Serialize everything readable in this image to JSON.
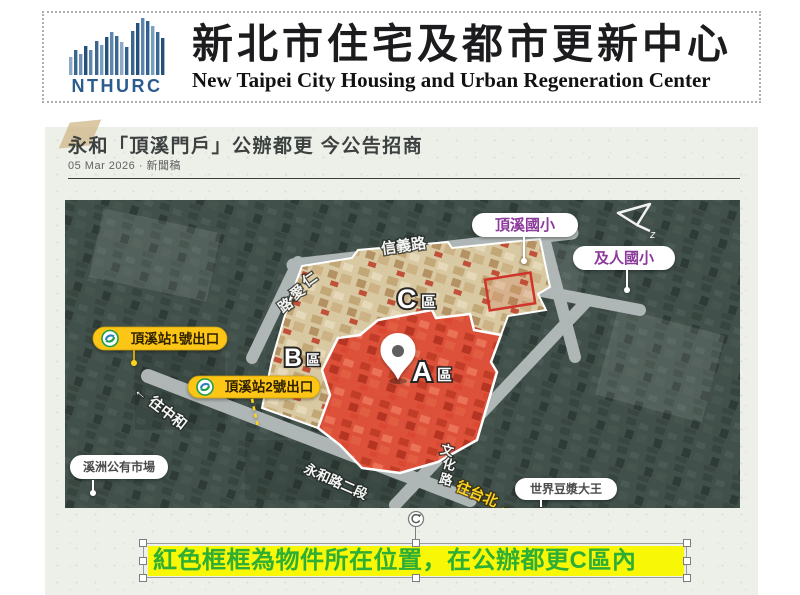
{
  "header": {
    "logo_text": "NTHURC",
    "title_zh": "新北市住宅及都市更新中心",
    "title_en": "New Taipei City Housing and Urban Regeneration Center"
  },
  "article": {
    "title": "永和「頂溪門戶」公辦都更 今公告招商",
    "date_line": "05 Mar 2026 · 新聞稿"
  },
  "map": {
    "road_labels": {
      "xinyi": "信義路",
      "renai_chars": [
        "仁",
        "愛",
        "路"
      ],
      "yonghe_section2": "永和路二段",
      "wenhua_chars": [
        "文",
        "化",
        "路"
      ]
    },
    "direction_labels": {
      "to_zhonghe": "← 往中和",
      "to_taipei": "往台北 →"
    },
    "zones": {
      "a": {
        "letter": "A",
        "suffix": "區"
      },
      "b": {
        "letter": "B",
        "suffix": "區"
      },
      "c": {
        "letter": "C",
        "suffix": "區"
      }
    },
    "poi_labels": {
      "dingxi_elementary": "頂溪國小",
      "jiren_elementary": "及人國小",
      "xizhou_market": "溪洲公有市場",
      "soymilk_king": "世界豆漿大王"
    },
    "metro_exit_labels": {
      "exit1": "頂溪站1號出口",
      "exit2": "頂溪站2號出口"
    },
    "compass_letter": "z"
  },
  "annotation": {
    "text": "紅色框框為物件所在位置，在公辦都更C區內"
  },
  "colors": {
    "accent_yellow_pill": "#fdc513",
    "highlight_yellow": "#f7f706",
    "annotation_green": "#2eae35",
    "zone_red": "#dd4731",
    "site_tan": "#d9c9a3",
    "school_purple": "#8b3a9b",
    "logo_blue": "#2b5c8e"
  }
}
